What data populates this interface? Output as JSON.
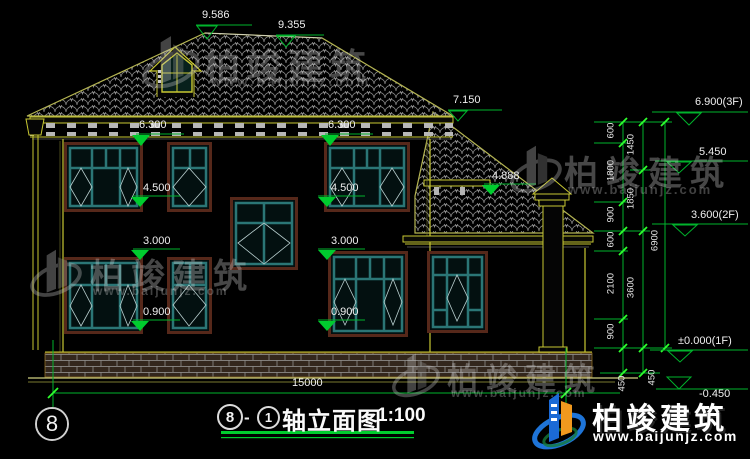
{
  "drawing": {
    "facade_dims": [
      "9.586",
      "9.355",
      "7.150",
      "6.300",
      "6.300",
      "4.500",
      "4.500",
      "4.888",
      "3.000",
      "3.000",
      "0.900",
      "0.900"
    ],
    "width_dim": "15000",
    "levels": [
      "6.900(3F)",
      "5.450",
      "3.600(2F)",
      "±0.000(1F)",
      "-0.450"
    ],
    "chain_a": [
      "600",
      "1800",
      "900",
      "600",
      "2100",
      "900",
      "450"
    ],
    "chain_b": [
      "1450",
      "1850",
      "3600",
      "450"
    ],
    "chain_total": "6900",
    "axis_bubble": "8"
  },
  "title": {
    "bubble_left": "8",
    "dash": "-",
    "bubble_right": "1",
    "text": "轴立面图",
    "scale": "1:100"
  },
  "watermark": {
    "brand": "柏竣建筑",
    "url": "www.baijunjz.com"
  },
  "logo": {
    "brand": "柏竣建筑",
    "url": "www.baijunjz.com"
  },
  "colors": {
    "dim_green": "#00b32c",
    "cad_olive": "#c8c832",
    "window_teal": "#2b7676",
    "logo_blue": "#1b6ad6",
    "logo_orange": "#f0991e"
  }
}
